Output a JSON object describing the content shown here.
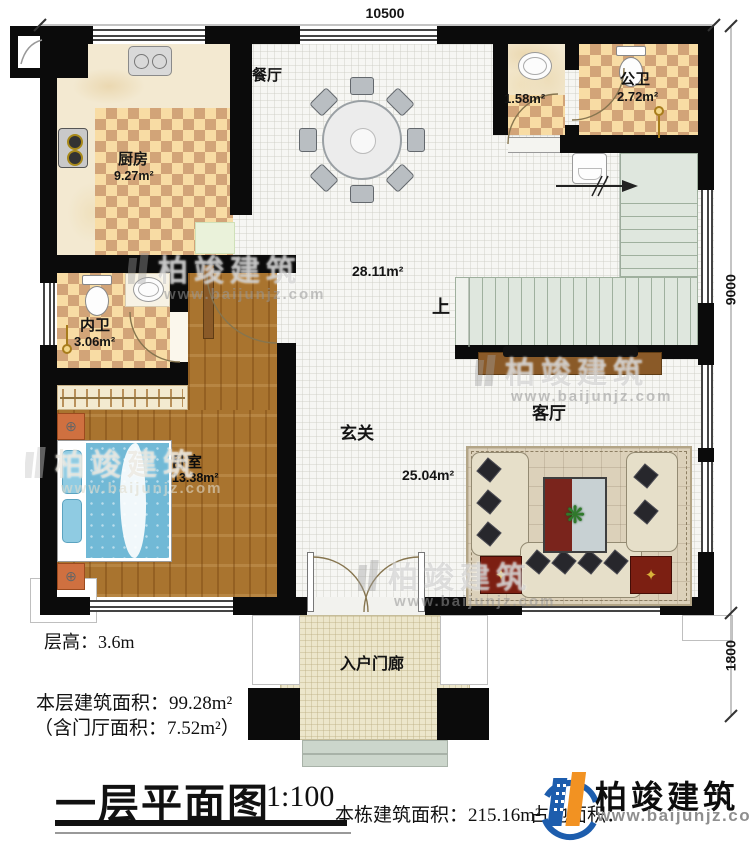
{
  "title": {
    "name": "一层平面图",
    "scale": "1:100"
  },
  "notes": {
    "floor_height": "层高：3.6m",
    "floor_area": "本层建筑面积：99.28m²",
    "foyer_area": "（含门厅面积：7.52m²）",
    "building_area": "本栋建筑面积：215.16m²",
    "site_area_fragment": "占地面积："
  },
  "dimensions": {
    "top": "10500",
    "right_upper": "9000",
    "right_lower": "1800"
  },
  "rooms": {
    "dining": {
      "name": "餐厅"
    },
    "kitchen": {
      "name": "厨房",
      "area": "9.27m²"
    },
    "washroom": {
      "area": "1.58m²"
    },
    "public_bath": {
      "name": "公卫",
      "area": "2.72m²"
    },
    "hall": {
      "area": "28.11m²"
    },
    "stairs": {
      "up_label": "上"
    },
    "private_bath": {
      "name": "内卫",
      "area": "3.06m²"
    },
    "bedroom": {
      "name": "卧室",
      "area": "13.38m²"
    },
    "foyer": {
      "name": "玄关",
      "area": "25.04m²"
    },
    "living": {
      "name": "客厅"
    },
    "porch": {
      "name": "入户门廊"
    }
  },
  "brand": {
    "name": "柏竣建筑",
    "url": "www.baijunjz.com"
  }
}
